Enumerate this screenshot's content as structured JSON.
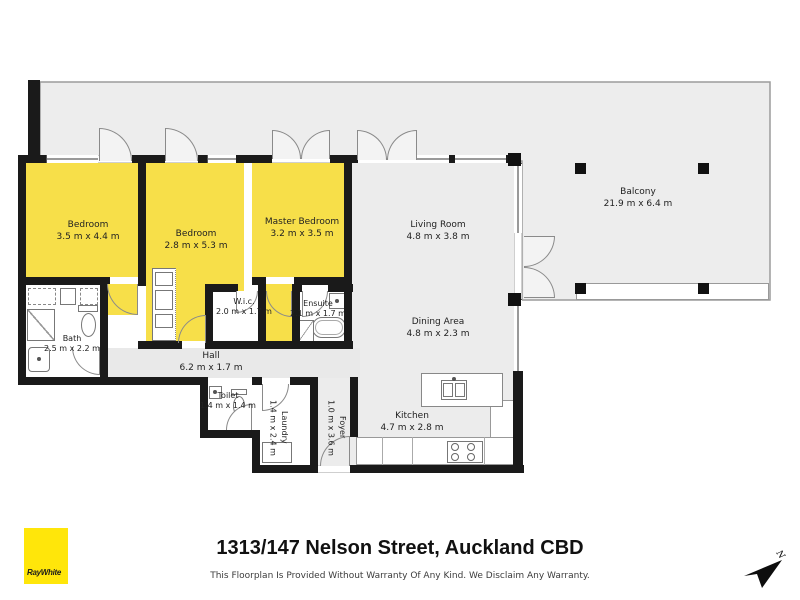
{
  "footer": {
    "address": "1313/147 Nelson Street, Auckland CBD",
    "disclaimer": "This Floorplan Is Provided Without Warranty Of Any Kind. We Disclaim Any Warranty."
  },
  "brand": {
    "name": "RayWhite"
  },
  "compass": {
    "label": "N"
  },
  "colors": {
    "bedroom_fill": "#F7DF49",
    "floor_fill": "#ECECEC",
    "hall_fill": "#E9E9E9",
    "wall": "#1A1A1A",
    "brand_yellow": "#FFE60A"
  },
  "rooms": [
    {
      "id": "bedroom1",
      "label": "Bedroom",
      "dims": "3.5 m x 4.4 m"
    },
    {
      "id": "bedroom2",
      "label": "Bedroom",
      "dims": "2.8 m x 5.3 m"
    },
    {
      "id": "master-bedroom",
      "label": "Master Bedroom",
      "dims": "3.2 m x 3.5 m"
    },
    {
      "id": "living-room",
      "label": "Living Room",
      "dims": "4.8 m x 3.8 m"
    },
    {
      "id": "dining-area",
      "label": "Dining Area",
      "dims": "4.8 m x 2.3 m"
    },
    {
      "id": "kitchen",
      "label": "Kitchen",
      "dims": "4.7 m x 2.8 m"
    },
    {
      "id": "balcony",
      "label": "Balcony",
      "dims": "21.9 m x 6.4 m"
    },
    {
      "id": "wic",
      "label": "W.i.c.",
      "dims": "2.0 m x 1.7 m"
    },
    {
      "id": "ensuite",
      "label": "Ensuite",
      "dims": "2.1 m x 1.7 m"
    },
    {
      "id": "bath",
      "label": "Bath",
      "dims": "2.5 m x 2.2 m"
    },
    {
      "id": "hall",
      "label": "Hall",
      "dims": "6.2 m x 1.7 m"
    },
    {
      "id": "toilet",
      "label": "Toilet",
      "dims": "1.4 m x 1.4 m"
    },
    {
      "id": "laundry",
      "label": "Laundry",
      "dims": "1.4 m x 2.4 m"
    },
    {
      "id": "foyer",
      "label": "Foyer",
      "dims": "1.0 m x 3.6 m"
    }
  ]
}
